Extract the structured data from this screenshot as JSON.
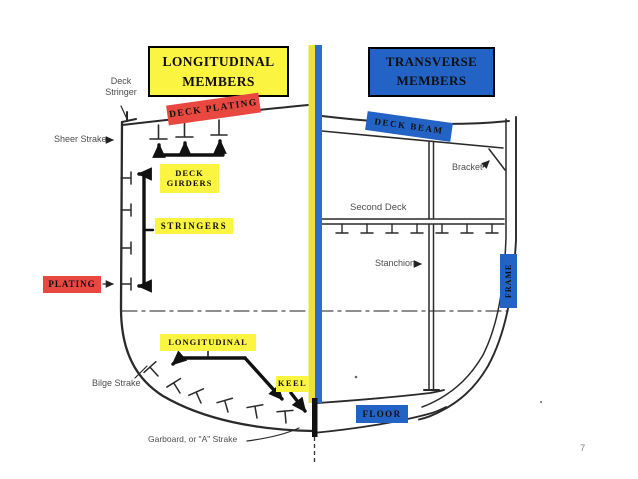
{
  "colors": {
    "yellow": "#fbf440",
    "red": "#e84840",
    "blue": "#2363c6",
    "strip-yellow": "#e8e33c",
    "strip-blue": "#2e6ccc",
    "ink": "#262626"
  },
  "titles": {
    "left": "LONGITUDINAL MEMBERS",
    "right": "TRANSVERSE MEMBERS"
  },
  "member_labels": {
    "deck_plating": "DECK PLATING",
    "deck_beam": "DECK BEAM",
    "deck_girders": "DECK GIRDERS",
    "stringers": "STRINGERS",
    "plating": "PLATING",
    "longitudinal": "LONGITUDINAL",
    "keel": "KEEL",
    "floor": "FLOOR",
    "frame": "FRAME"
  },
  "drawing_labels": {
    "deck_stringer": "Deck Stringer",
    "sheer_strake": "Sheer Strake",
    "bracket": "Bracket",
    "second_deck": "Second Deck",
    "stanchion": "Stanchion",
    "bilge_strake": "Bilge Strake",
    "garboard": "Garboard, or \"A\" Strake"
  },
  "page": {
    "number": "7"
  }
}
